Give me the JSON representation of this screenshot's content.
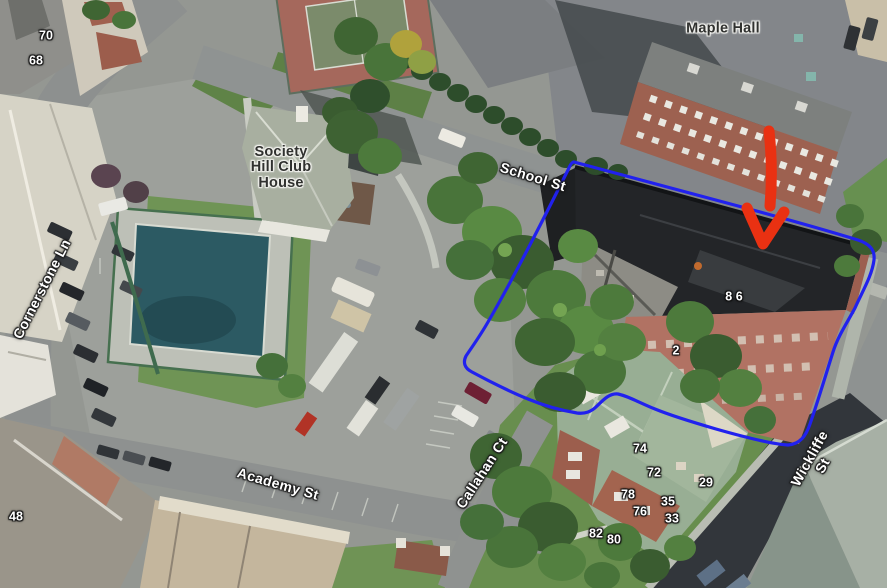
{
  "annotations": {
    "outline_color": "#2121ee",
    "arrow_color": "#e93112"
  },
  "labels": {
    "streets": [
      {
        "text": "School St",
        "x": 533,
        "y": 177,
        "rot": 17
      },
      {
        "text": "Cornerstone Ln",
        "x": 42,
        "y": 289,
        "rot": -63
      },
      {
        "text": "Academy St",
        "x": 278,
        "y": 484,
        "rot": 16
      },
      {
        "text": "Callahan Ct",
        "x": 482,
        "y": 473,
        "rot": -57
      },
      {
        "text": "Wickliffe St",
        "x": 816,
        "y": 462,
        "rot": -61
      }
    ],
    "places": [
      {
        "text": "Maple Hall",
        "x": 723,
        "y": 29,
        "rot": 0
      },
      {
        "text": "Society\nHill Club\nHouse",
        "x": 281,
        "y": 168,
        "rot": 0
      }
    ],
    "numbers": [
      {
        "text": "70",
        "x": 46,
        "y": 36
      },
      {
        "text": "68",
        "x": 36,
        "y": 61
      },
      {
        "text": "48",
        "x": 16,
        "y": 517
      },
      {
        "text": "8 6",
        "x": 734,
        "y": 297
      },
      {
        "text": "2",
        "x": 676,
        "y": 351
      },
      {
        "text": "74",
        "x": 640,
        "y": 449
      },
      {
        "text": "72",
        "x": 654,
        "y": 473
      },
      {
        "text": "29",
        "x": 706,
        "y": 483
      },
      {
        "text": "78",
        "x": 628,
        "y": 495
      },
      {
        "text": "35",
        "x": 668,
        "y": 502
      },
      {
        "text": "76",
        "x": 640,
        "y": 512
      },
      {
        "text": "33",
        "x": 672,
        "y": 519
      },
      {
        "text": "82",
        "x": 596,
        "y": 534
      },
      {
        "text": "80",
        "x": 614,
        "y": 540
      }
    ]
  }
}
